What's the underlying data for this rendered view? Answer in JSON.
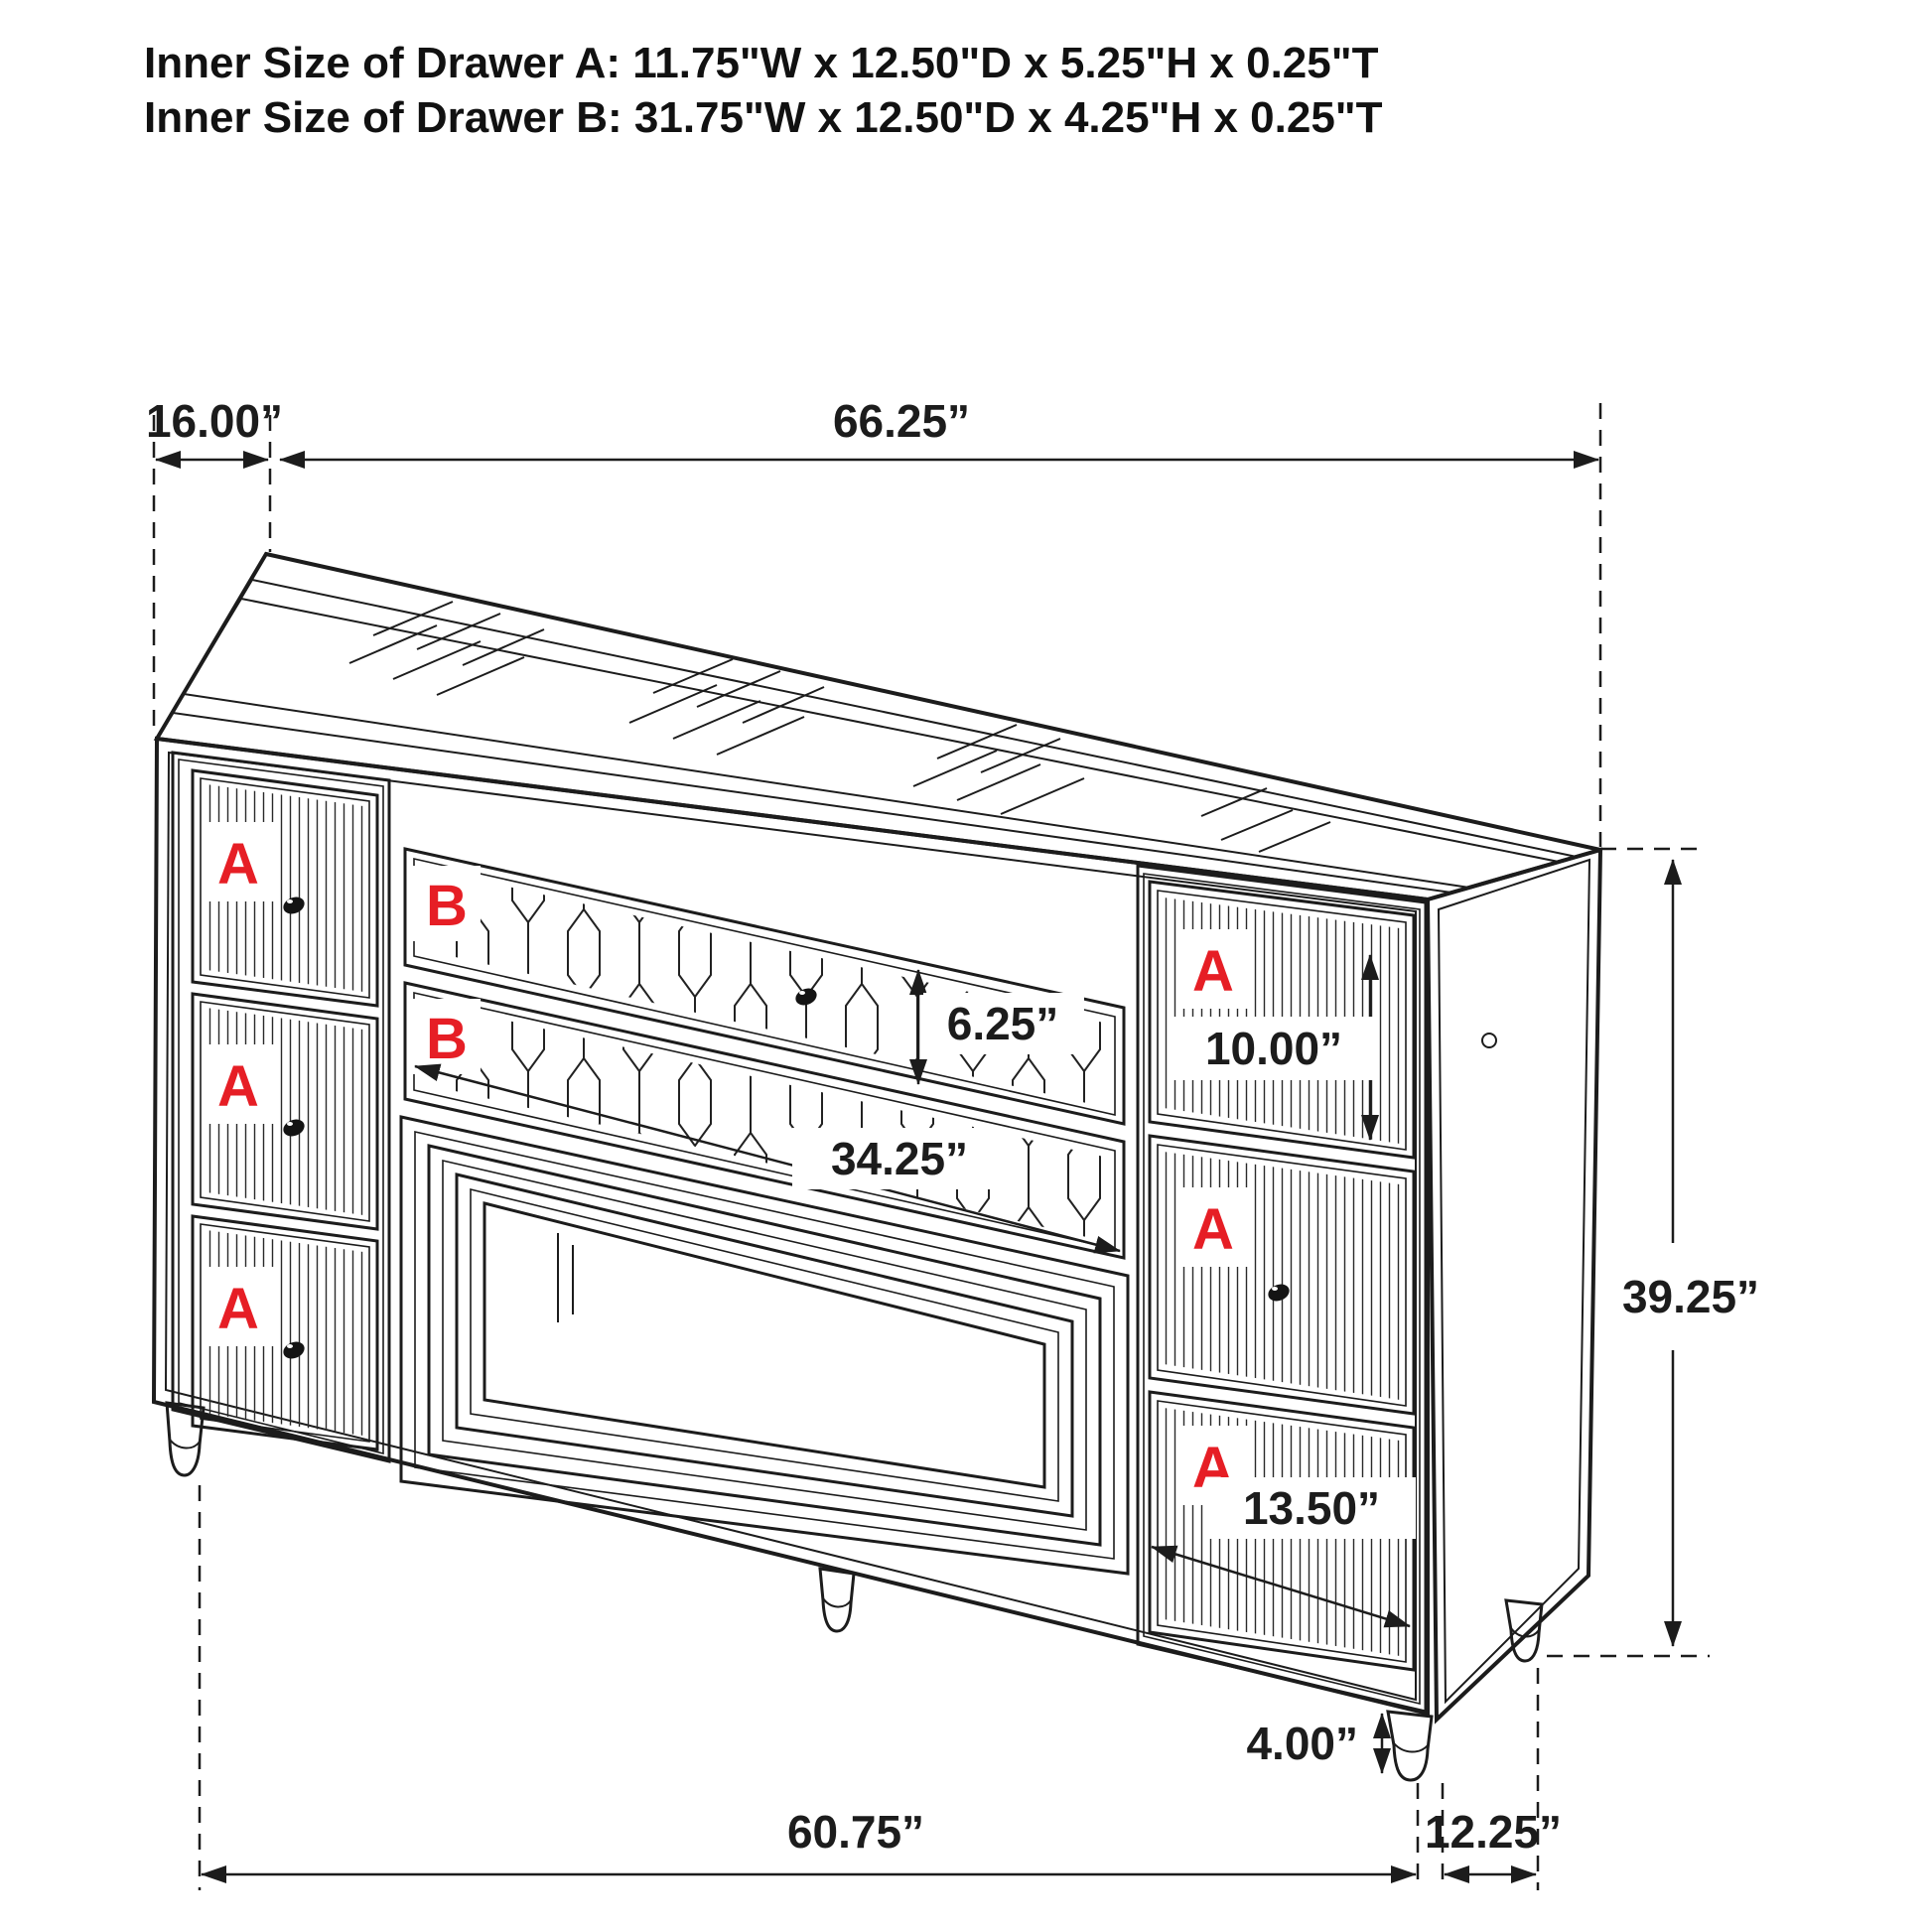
{
  "title": {
    "line1": "Inner Size of Drawer A: 11.75\"W x 12.50\"D x 5.25\"H x 0.25\"T",
    "line2": "Inner Size of Drawer B: 31.75\"W x 12.50\"D x 4.25\"H x 0.25\"T"
  },
  "drawer_labels": {
    "a": "A",
    "b": "B"
  },
  "dimensions": {
    "top_depth": "16.00”",
    "top_width": "66.25”",
    "drawer_b_height": "6.25”",
    "drawer_b_width": "34.25”",
    "right_drawer_height": "10.00”",
    "cabinet_height": "39.25”",
    "right_drawer_width": "13.50”",
    "leg_height": "4.00”",
    "bottom_width": "60.75”",
    "bottom_depth": "12.25”"
  },
  "colors": {
    "label_red": "#e61e25",
    "line_dark": "#1c1c1c"
  }
}
